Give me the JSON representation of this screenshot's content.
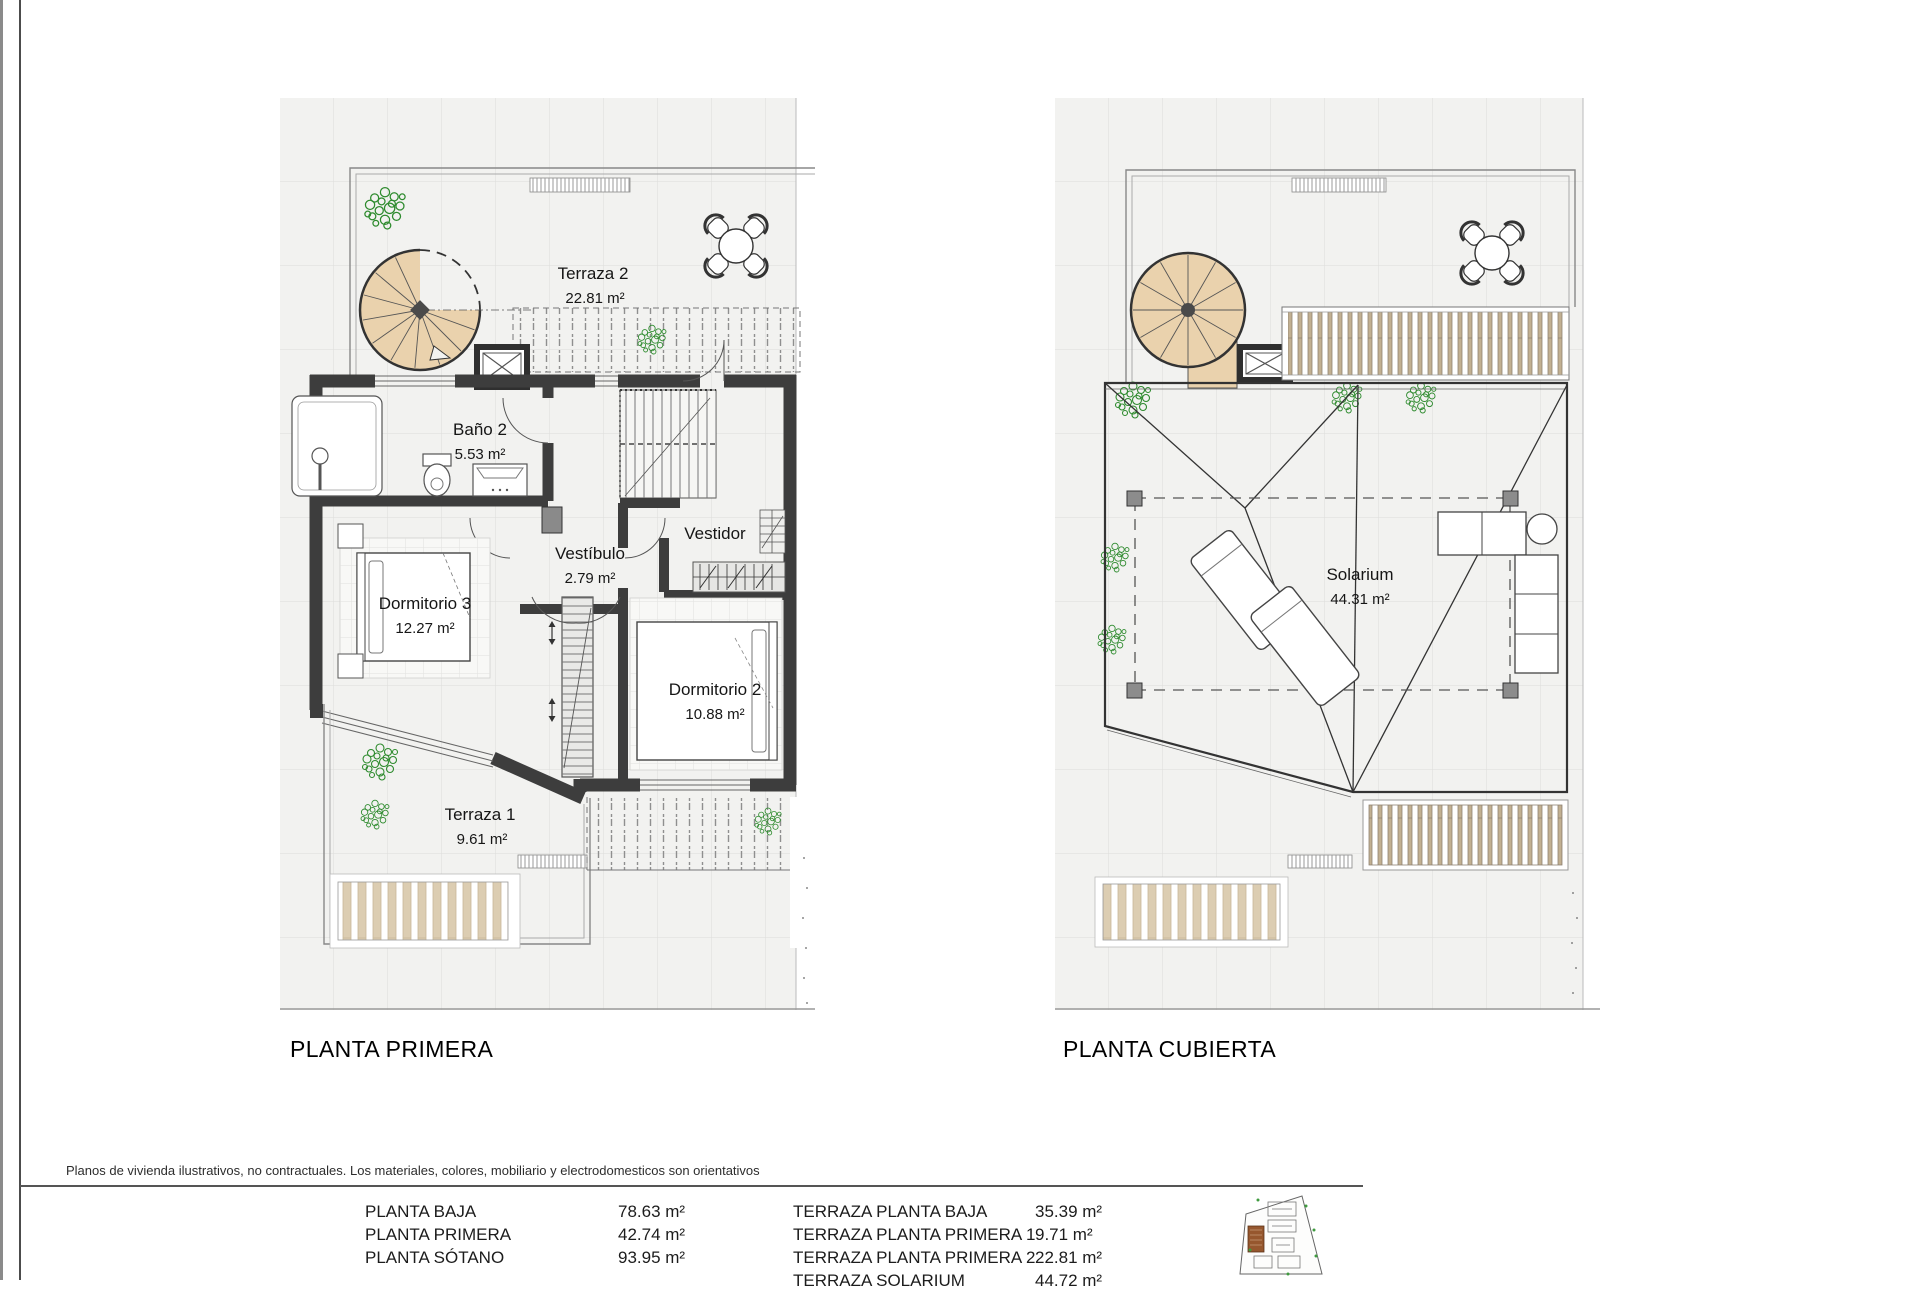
{
  "plans": [
    {
      "title": "PLANTA PRIMERA",
      "rooms": [
        {
          "name": "Terraza 2",
          "area": "22.81 m²"
        },
        {
          "name": "Baño 2",
          "area": "5.53 m²"
        },
        {
          "name": "Vestíbulo",
          "area": "2.79 m²"
        },
        {
          "name": "Vestidor",
          "area": ""
        },
        {
          "name": "Dormitorio 3",
          "area": "12.27 m²"
        },
        {
          "name": "Dormitorio 2",
          "area": "10.88 m²"
        },
        {
          "name": "Terraza 1",
          "area": "9.61 m²"
        }
      ]
    },
    {
      "title": "PLANTA CUBIERTA",
      "rooms": [
        {
          "name": "Solarium",
          "area": "44.31 m²"
        }
      ]
    }
  ],
  "disclaimer": "Planos de vivienda ilustrativos, no contractuales. Los materiales, colores, mobiliario y electrodomesticos son orientativos",
  "areas_table": {
    "left": [
      {
        "label": "PLANTA BAJA",
        "value": "78.63 m²"
      },
      {
        "label": "PLANTA PRIMERA",
        "value": "42.74 m²"
      },
      {
        "label": "PLANTA SÓTANO",
        "value": "93.95 m²"
      }
    ],
    "right": [
      {
        "label": "TERRAZA PLANTA BAJA",
        "value": "35.39 m²"
      },
      {
        "label": "TERRAZA PLANTA PRIMERA 1",
        "value": "9.71 m²"
      },
      {
        "label": "TERRAZA PLANTA PRIMERA 2",
        "value": "22.81 m²"
      },
      {
        "label": "TERRAZA SOLARIUM",
        "value": "44.72 m²"
      }
    ]
  },
  "colors": {
    "stair_tan": "#ead2ad",
    "plant_green": "#2e8b2e",
    "wall_dark": "#3d3d3d"
  }
}
